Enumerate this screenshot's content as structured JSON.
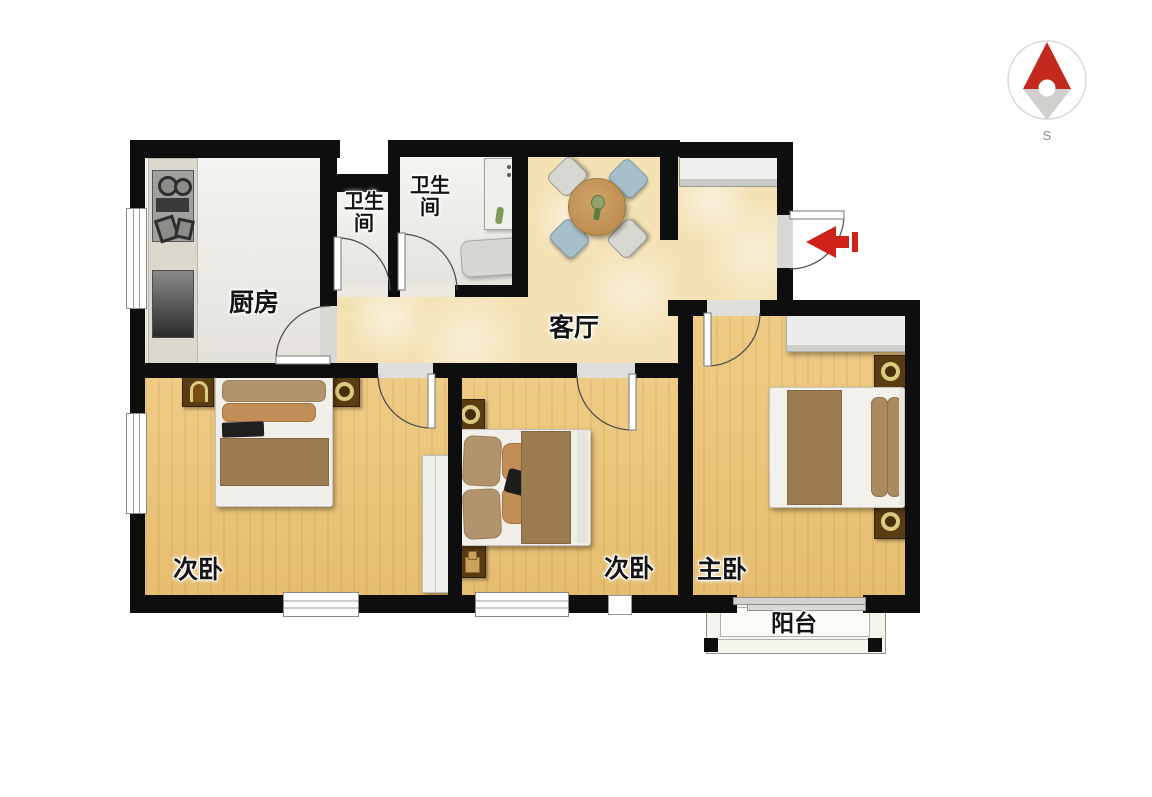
{
  "compass": {
    "south_label": "S",
    "needle_red": "#c4291d",
    "needle_gray": "#d2d0cc"
  },
  "entry": {
    "arrow_color": "#cf231a"
  },
  "rooms": {
    "kitchen": {
      "label": "厨房"
    },
    "bath_small": {
      "label": "卫生间"
    },
    "bath_large": {
      "label": "卫生间"
    },
    "living": {
      "label": "客厅"
    },
    "bedroom_left": {
      "label": "次卧"
    },
    "bedroom_middle": {
      "label": "次卧"
    },
    "master_bedroom": {
      "label": "主卧"
    },
    "balcony": {
      "label": "阳台"
    }
  },
  "palette": {
    "wall": "#0e0e0e",
    "wood_floor": "#ebc77e",
    "marble_floor": "#f4e2b4",
    "tile_floor": "#ebe9e2",
    "balcony_floor": "#f6f5ee",
    "duvet_brown": "#9b7c51",
    "pillow_tan": "#b1946e",
    "pillow_orange": "#c18e57",
    "nightstand_brown": "#5a3c12",
    "nightstand_ring_gold": "#d9cb80",
    "table_wood": "#c59a5f",
    "chair_blue": "#a7becb",
    "chair_gray": "#d8d8d2"
  }
}
